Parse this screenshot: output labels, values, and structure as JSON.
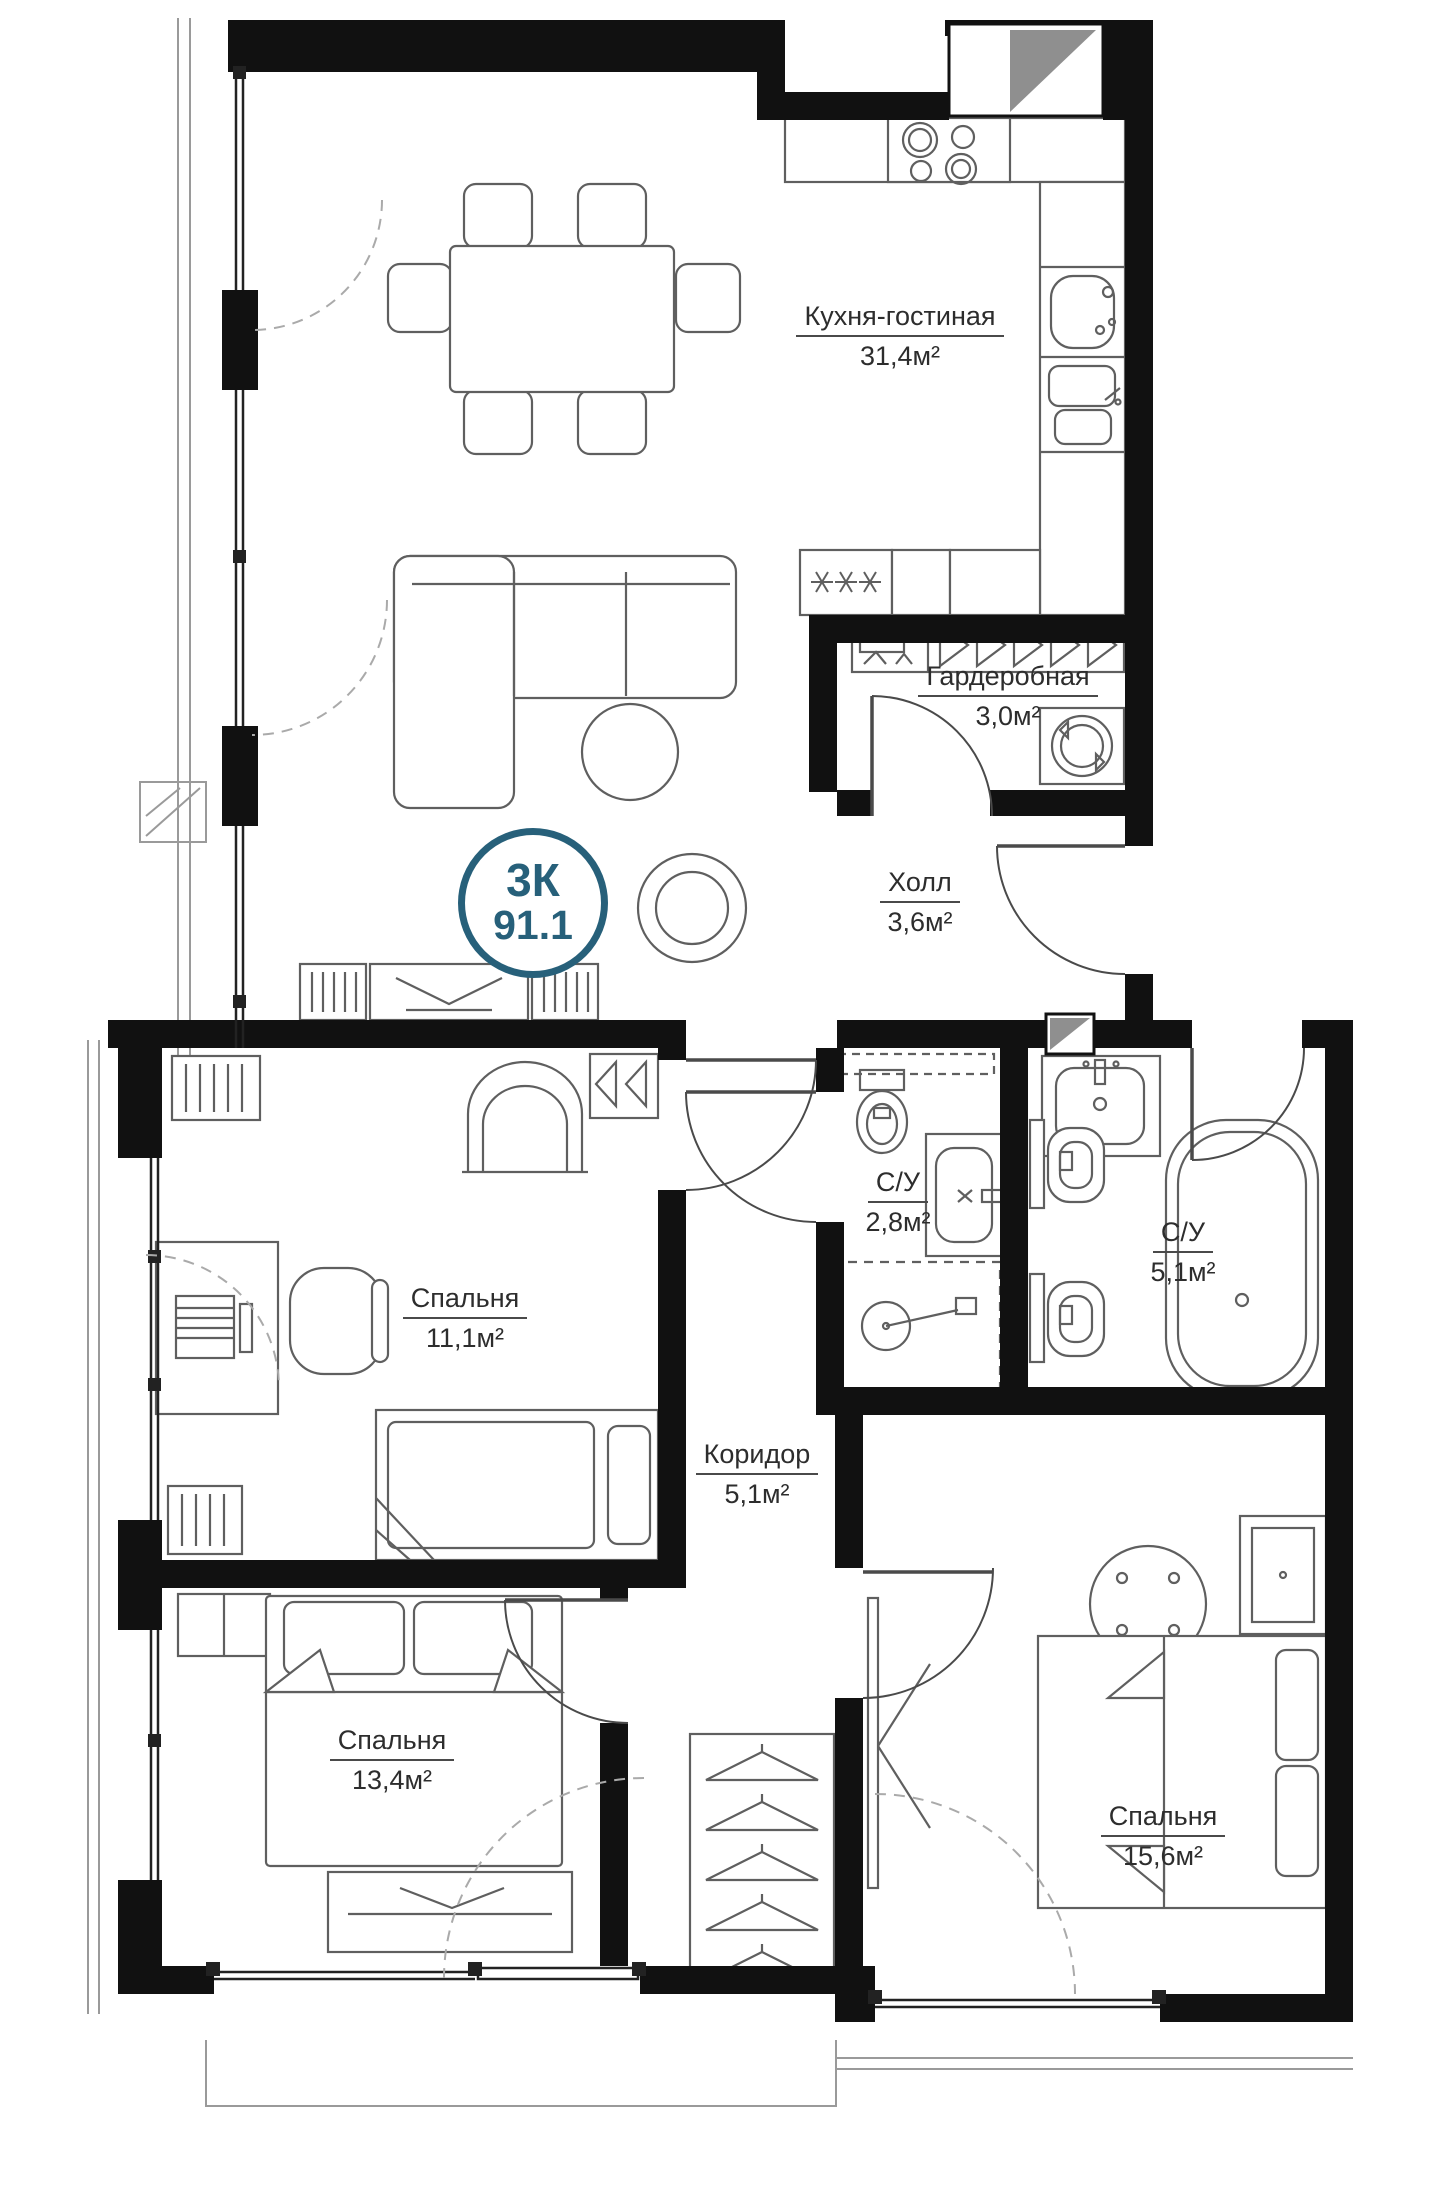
{
  "plan": {
    "badge": {
      "type_label": "3К",
      "total_area": "91.1"
    },
    "rooms": [
      {
        "id": "kitchen-living",
        "name": "Кухня-гостиная",
        "area": "31,4м²"
      },
      {
        "id": "wardrobe",
        "name": "Гардеробная",
        "area": "3,0м²"
      },
      {
        "id": "hall",
        "name": "Холл",
        "area": "3,6м²"
      },
      {
        "id": "bathroom-guest",
        "name": "С/У",
        "area": "2,8м²"
      },
      {
        "id": "bathroom-master",
        "name": "С/У",
        "area": "5,1м²"
      },
      {
        "id": "bedroom-1",
        "name": "Спальня",
        "area": "11,1м²"
      },
      {
        "id": "corridor",
        "name": "Коридор",
        "area": "5,1м²"
      },
      {
        "id": "bedroom-2",
        "name": "Спальня",
        "area": "13,4м²"
      },
      {
        "id": "bedroom-3",
        "name": "Спальня",
        "area": "15,6м²"
      }
    ],
    "colors": {
      "badge_accent": "#27607a",
      "walls": "#111111",
      "furniture_line": "#5f5f5f"
    }
  }
}
